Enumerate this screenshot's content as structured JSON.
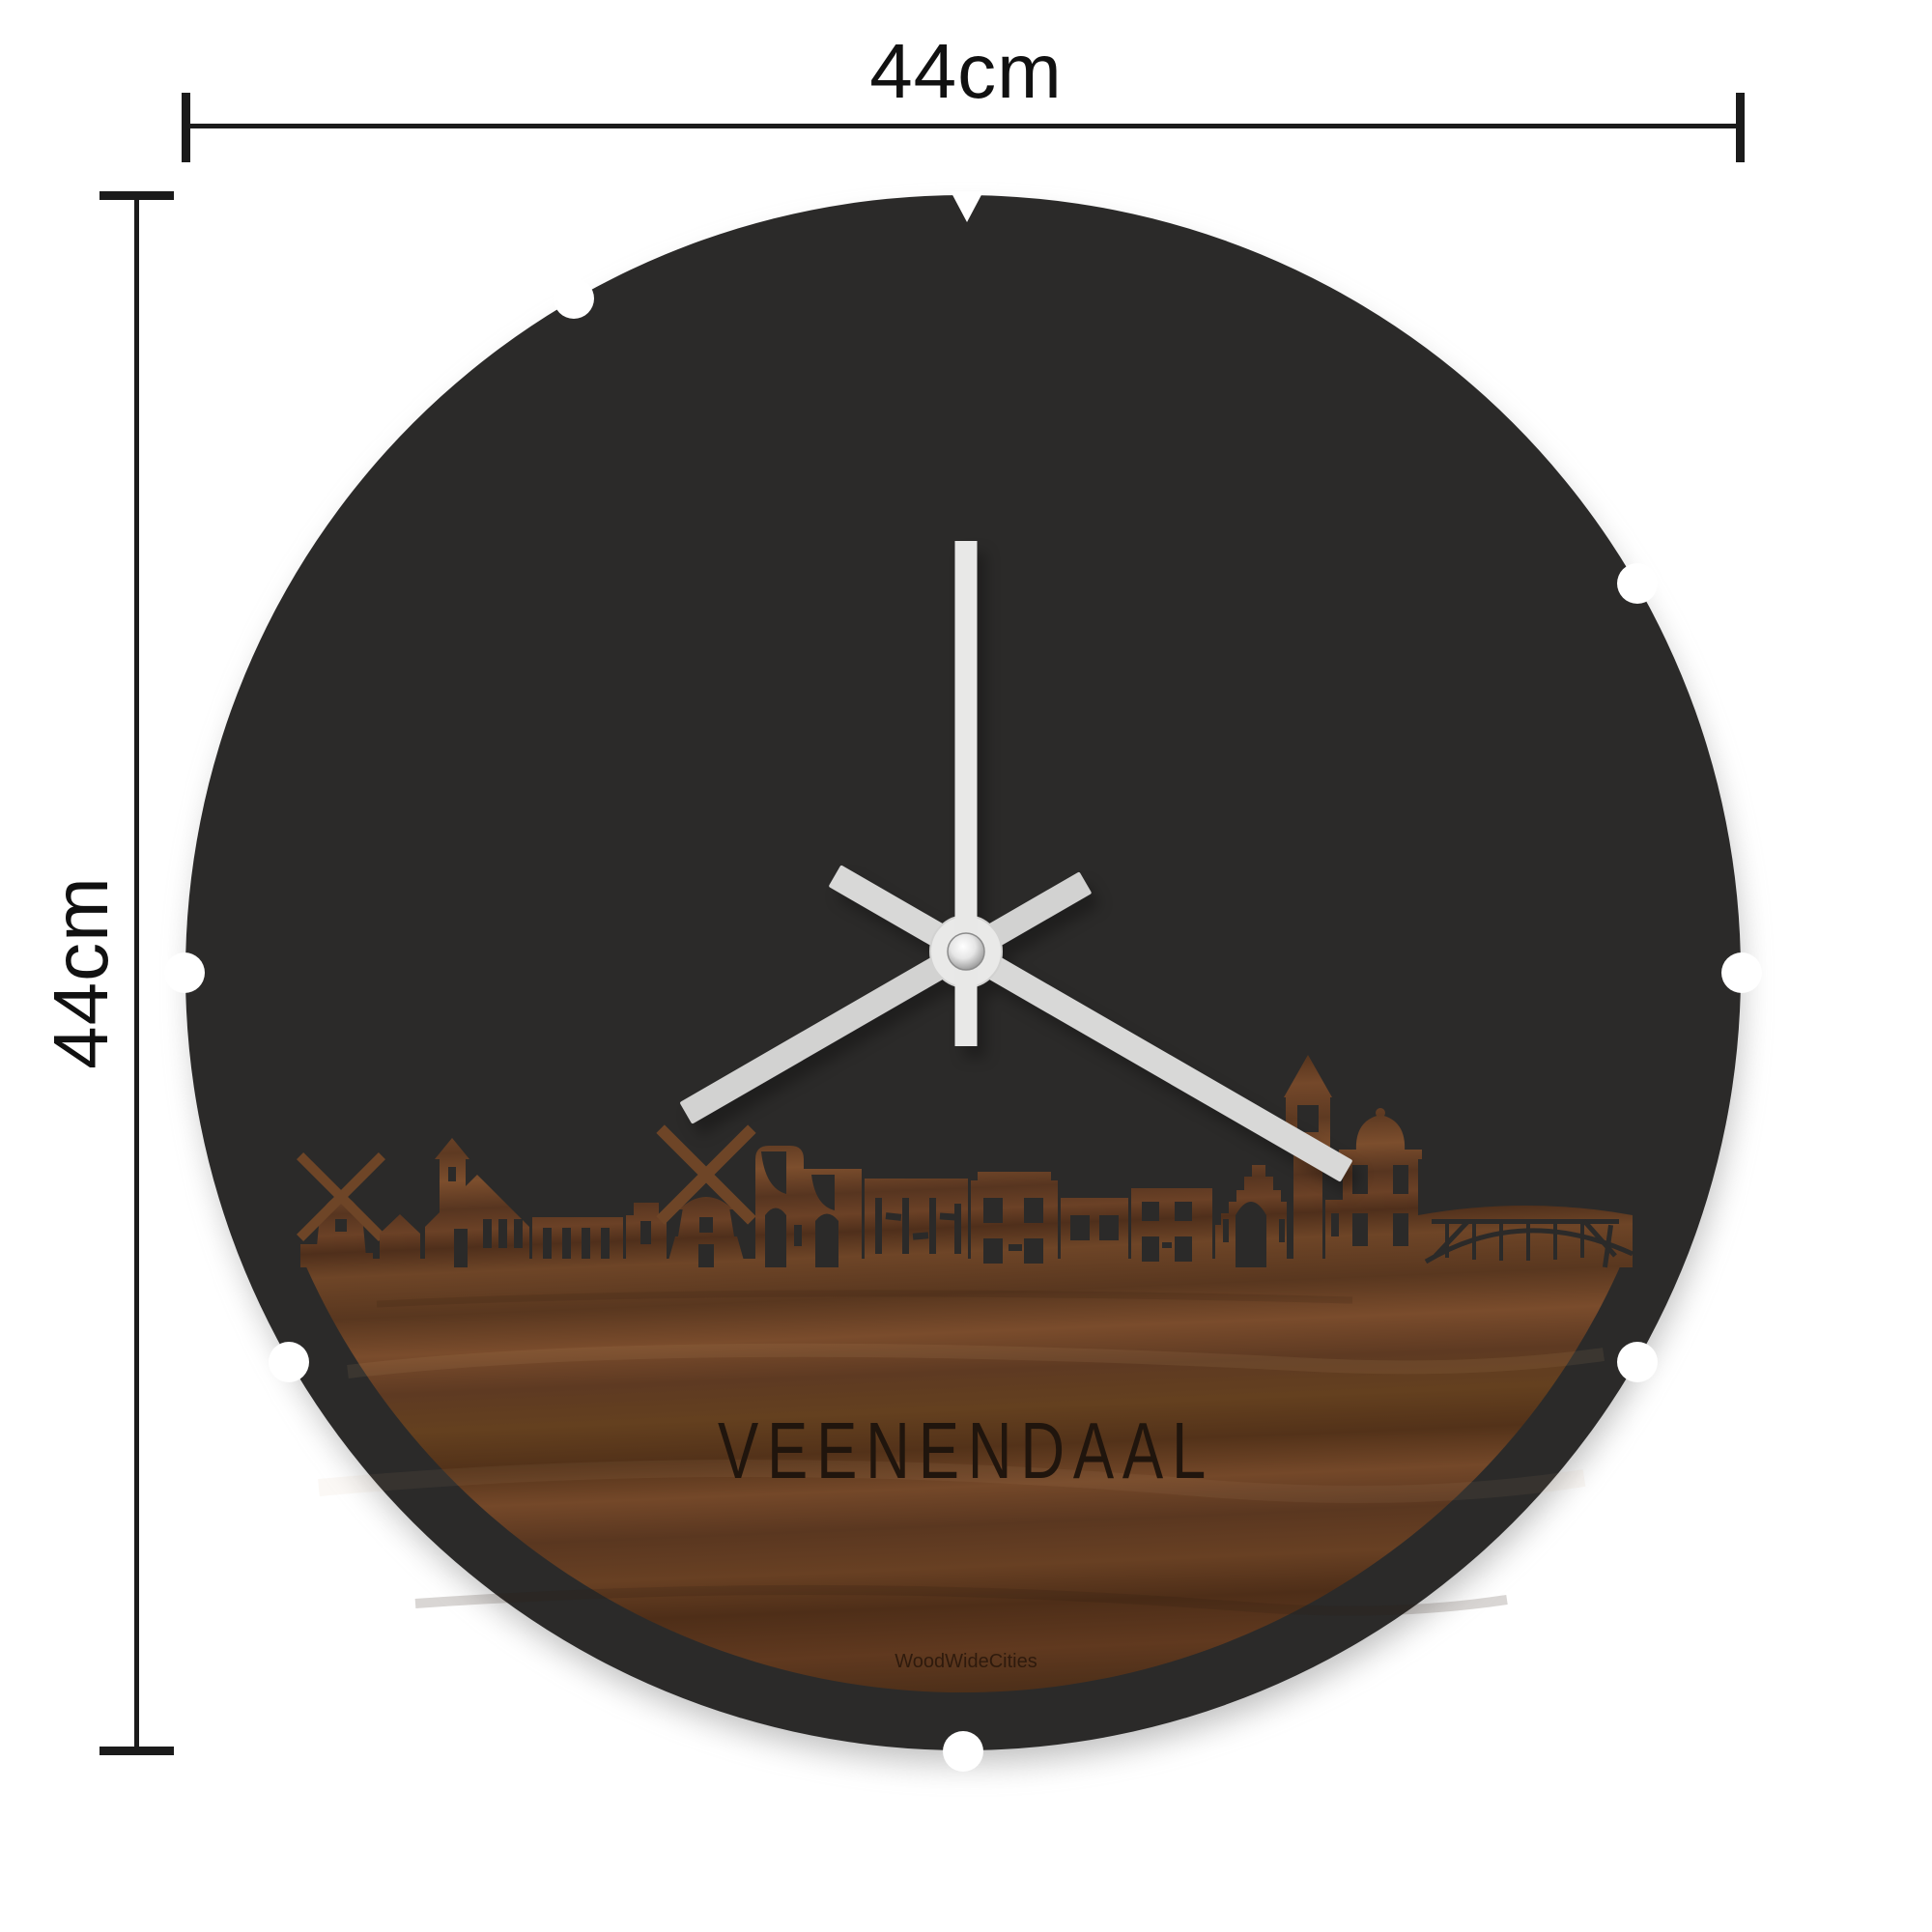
{
  "page": {
    "background": "#ffffff"
  },
  "dimensions": {
    "width_label": "44cm",
    "height_label": "44cm",
    "line_color": "#1b1b1b"
  },
  "clock": {
    "city_label": "VEENENDAAL",
    "brand_label": "WoodWideCities",
    "face_color": "#2b2a29",
    "engraving_color": "#20150d",
    "edge_notch_count": 8,
    "hands": {
      "second_color": "#e8e8e7",
      "minute_color": "#d8d8d7",
      "hour_color": "#d2d2d1",
      "hub_color": "#e9e9e8",
      "second_angle_deg": 0,
      "minute_angle_deg": 120,
      "hour_angle_deg": 240,
      "position_reading": "hands at 12, 4 and 8"
    },
    "wood": {
      "tone_dark": "#4e2f1a",
      "tone_mid": "#64401f",
      "tone_light": "#7c4e2d"
    },
    "skyline_features": [
      "windmill-small",
      "house",
      "church-with-tower",
      "row-building",
      "stepped-building",
      "windmill-large",
      "gate-with-arches",
      "shop-row",
      "stepped-gable-church",
      "clock-tower",
      "domed-building",
      "truss-bridge"
    ]
  }
}
